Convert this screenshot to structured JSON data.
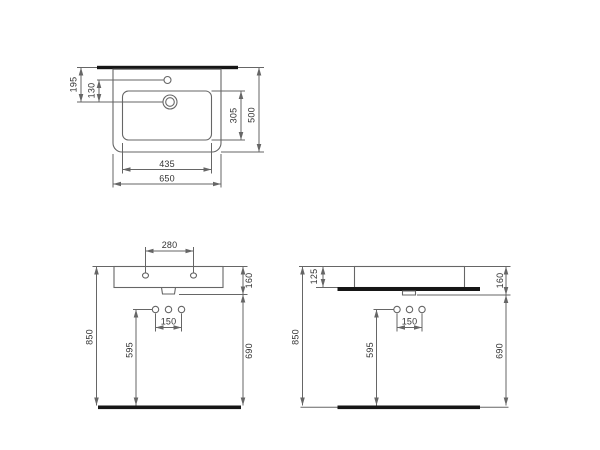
{
  "colors": {
    "line": "#666666",
    "text": "#333333",
    "bar": "#161616",
    "bg": "#ffffff"
  },
  "views": {
    "top": {
      "dims": {
        "total_width": "650",
        "bowl_width": "435",
        "total_depth": "500",
        "bowl_depth": "305",
        "drain_from_back": "195",
        "tap_to_drain": "130"
      }
    },
    "front": {
      "dims": {
        "tap_hole_spacing": "280",
        "basin_height": "160",
        "supply_spacing": "150",
        "supply_height": "595",
        "rim_height": "850",
        "bottom_clearance": "690"
      }
    },
    "side": {
      "dims": {
        "deck_thickness": "125",
        "basin_height": "160",
        "supply_spacing": "150",
        "supply_height": "595",
        "rim_height": "850",
        "bottom_clearance": "690"
      }
    }
  }
}
